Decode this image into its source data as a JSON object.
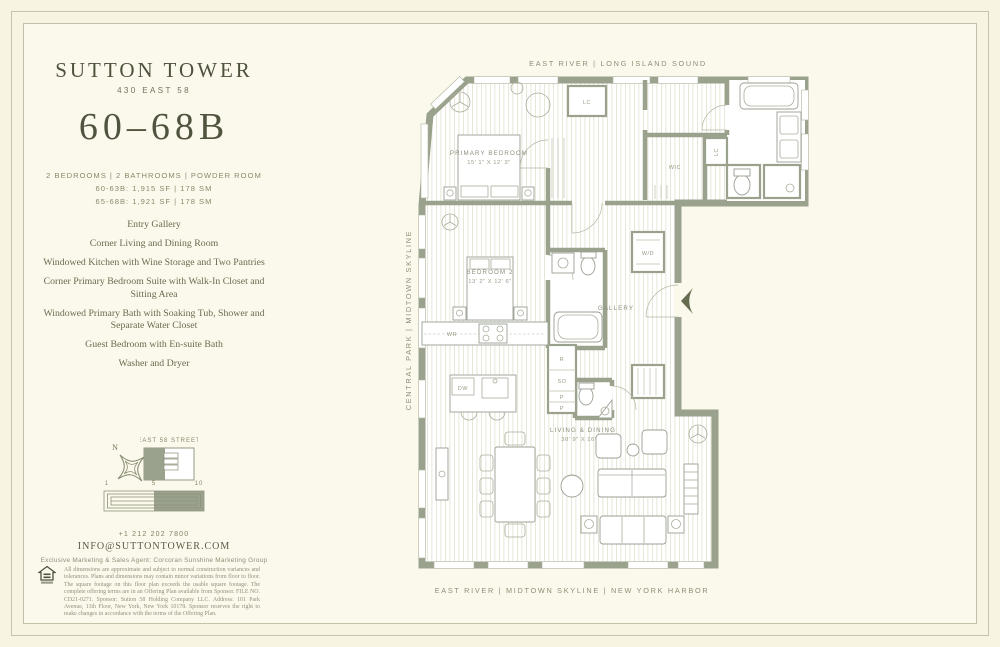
{
  "brand": {
    "title": "SUTTON TOWER",
    "address": "430 EAST 58"
  },
  "unit": {
    "number": "60–68B",
    "config": "2 BEDROOMS | 2 BATHROOMS | POWDER ROOM",
    "area_line_1": "60-63B: 1,915 SF | 178 SM",
    "area_line_2": "65-68B: 1,921 SF | 178 SM"
  },
  "features": [
    "Entry Gallery",
    "Corner Living and Dining Room",
    "Windowed Kitchen with Wine Storage and Two Pantries",
    "Corner Primary Bedroom Suite with Walk-In Closet and Sitting Area",
    "Windowed Primary Bath with Soaking Tub, Shower and Separate Water Closet",
    "Guest Bedroom with En-suite Bath",
    "Washer and Dryer"
  ],
  "keyplan": {
    "street": "EAST 58 STREET",
    "north": "N"
  },
  "scalebar": {
    "ticks": [
      "1",
      "5",
      "10"
    ]
  },
  "contact": {
    "phone": "+1 212 202 7800",
    "email": "INFO@SUTTONTOWER.COM",
    "agent": "Exclusive Marketing & Sales Agent: Corcoran Sunshine Marketing Group"
  },
  "legal": {
    "disclaimer": "All dimensions are approximate and subject to normal construction variances and tolerances. Plans and dimensions may contain minor variations from floor to floor. The square footage on this floor plan exceeds the usable square footage. The complete offering terms are in an Offering Plan available from Sponsor. FILE NO. CD21-0271. Sponsor: Sutton 58 Holding Company LLC. Address: 101 Park Avenue, 11th Floor, New York, New York 10178. Sponsor reserves the right to make changes in accordance with the terms of the Offering Plan."
  },
  "plan": {
    "captions": {
      "top": "EAST RIVER | LONG ISLAND SOUND",
      "left": "CENTRAL PARK | MIDTOWN SKYLINE",
      "bottom": "EAST RIVER | MIDTOWN SKYLINE | NEW YORK HARBOR"
    },
    "rooms": {
      "primary_bedroom": {
        "name": "PRIMARY BEDROOM",
        "dims": "15' 1\" X 12' 3\""
      },
      "bedroom_2": {
        "name": "BEDROOM 2",
        "dims": "13' 2\" X 12' 6\""
      },
      "living_dining": {
        "name": "LIVING & DINING",
        "dims": "30' 9\" X 16' 9\""
      },
      "gallery": "GALLERY"
    },
    "labels": {
      "wic": "WIC",
      "lc": "LC",
      "wd": "W/D",
      "wr": "WR",
      "dw": "DW",
      "r": "R",
      "so": "SO",
      "p": "P"
    }
  }
}
